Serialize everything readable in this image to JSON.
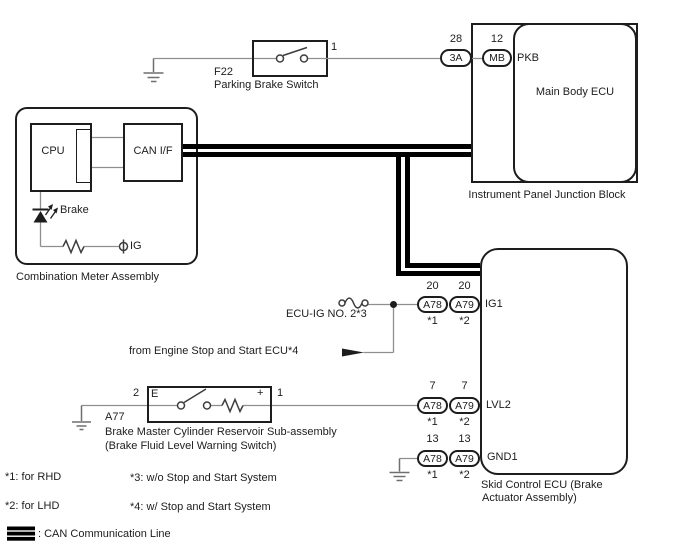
{
  "colors": {
    "background": "#ffffff",
    "wire": "#8f8f8f",
    "symbol": "#3d3d3d",
    "outline": "#1d1d1d",
    "can_line": "#000000"
  },
  "parking_brake_switch": {
    "code": "F22",
    "name": "Parking Brake Switch",
    "pin": "1"
  },
  "junction_block": {
    "title": "Instrument Panel Junction Block",
    "ecu": "Main Body ECU",
    "signal": "PKB",
    "connectors": [
      {
        "pin": "28",
        "id": "3A"
      },
      {
        "pin": "12",
        "id": "MB"
      }
    ]
  },
  "combination_meter": {
    "title": "Combination Meter Assembly",
    "cpu": "CPU",
    "can_if": "CAN I/F",
    "indicator": "Brake",
    "terminal": "IG"
  },
  "fuse": {
    "label": "ECU-IG NO. 2*3"
  },
  "engine_ecu_note": "from Engine Stop and Start ECU*4",
  "skid_control_ecu": {
    "title_line1": "Skid Control ECU (Brake",
    "title_line2": "Actuator Assembly)",
    "rows": [
      {
        "signal": "IG1",
        "left": {
          "pin": "20",
          "conn": "A78",
          "note": "*1"
        },
        "right": {
          "pin": "20",
          "conn": "A79",
          "note": "*2"
        }
      },
      {
        "signal": "LVL2",
        "left": {
          "pin": "7",
          "conn": "A78",
          "note": "*1"
        },
        "right": {
          "pin": "7",
          "conn": "A79",
          "note": "*2"
        }
      },
      {
        "signal": "GND1",
        "left": {
          "pin": "13",
          "conn": "A78",
          "note": "*1"
        },
        "right": {
          "pin": "13",
          "conn": "A79",
          "note": "*2"
        }
      }
    ]
  },
  "reservoir": {
    "code": "A77",
    "pin_left": "2",
    "pin_right": "1",
    "terminal_left": "E",
    "terminal_right": "+",
    "name_line1": "Brake Master Cylinder Reservoir Sub-assembly",
    "name_line2": "(Brake Fluid Level Warning Switch)"
  },
  "footnotes": [
    "*1: for RHD",
    "*2: for LHD",
    "*3: w/o Stop and Start System",
    "*4: w/ Stop and Start System"
  ],
  "legend": {
    "can_label": ": CAN Communication Line"
  }
}
